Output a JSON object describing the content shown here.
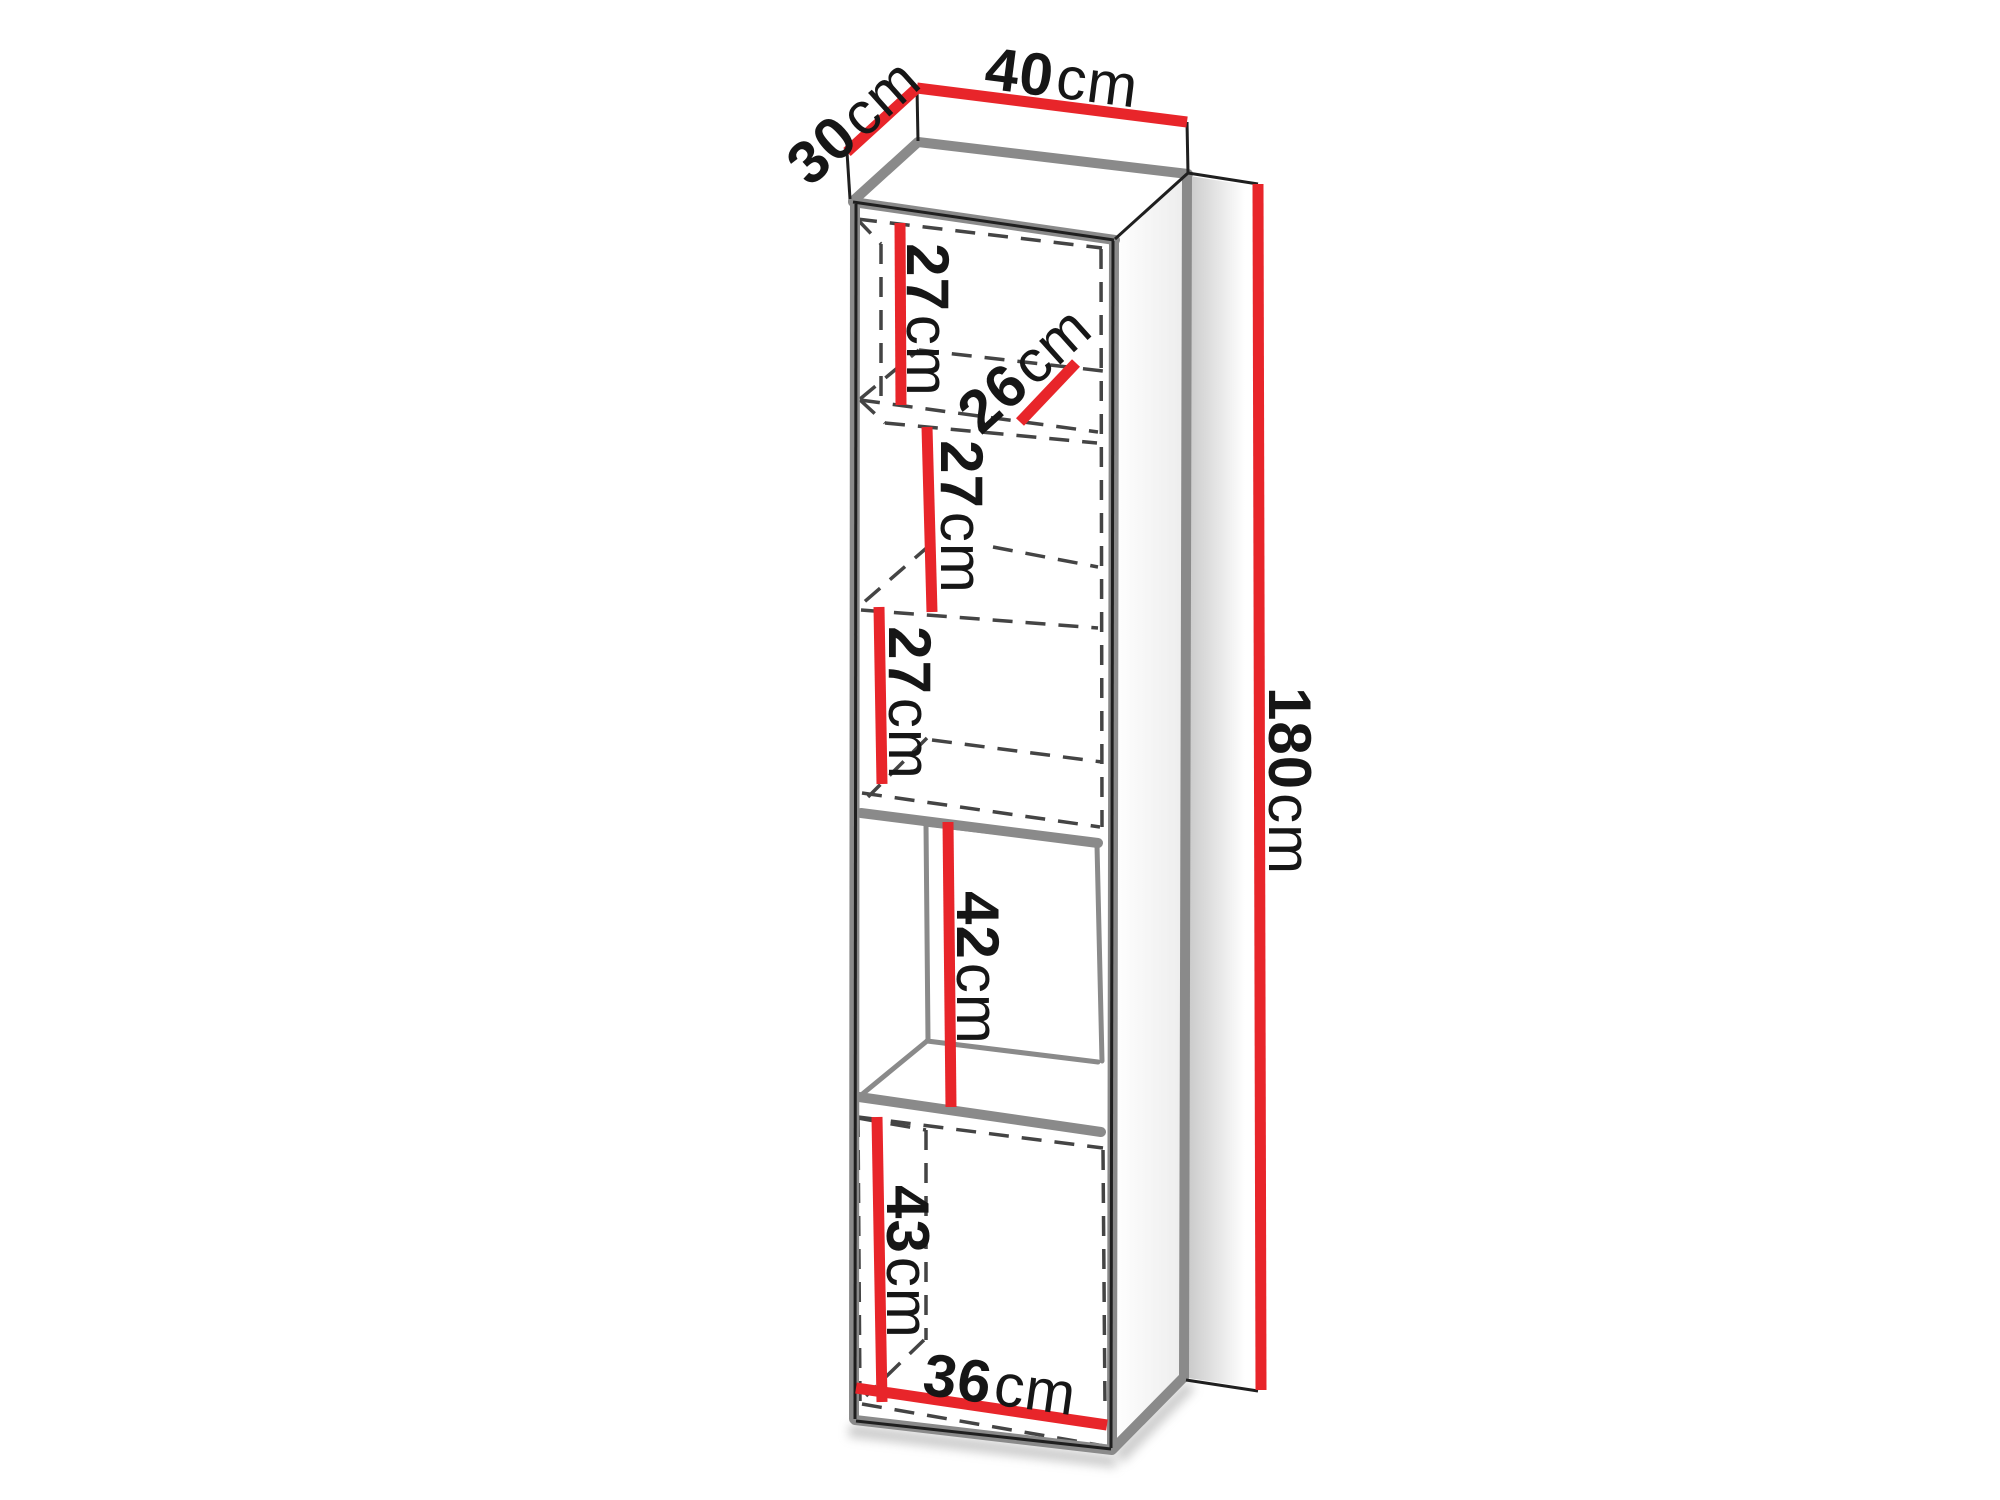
{
  "diagram": {
    "kind": "furniture-dimension-drawing",
    "colors": {
      "dimension_red": "#e8252a",
      "edge_gray": "#8a8a8a",
      "line_dark": "#1f1f1f",
      "background": "#ffffff"
    }
  },
  "dims": {
    "top_depth": {
      "value": "30",
      "unit": "cm"
    },
    "top_width": {
      "value": "40",
      "unit": "cm"
    },
    "height": {
      "value": "180",
      "unit": "cm"
    },
    "compartment1": {
      "value": "27",
      "unit": "cm"
    },
    "shelf_depth": {
      "value": "26",
      "unit": "cm"
    },
    "compartment2": {
      "value": "27",
      "unit": "cm"
    },
    "compartment3": {
      "value": "27",
      "unit": "cm"
    },
    "open_niche": {
      "value": "42",
      "unit": "cm"
    },
    "bottom_compartment": {
      "value": "43",
      "unit": "cm"
    },
    "inner_width": {
      "value": "36",
      "unit": "cm"
    }
  }
}
